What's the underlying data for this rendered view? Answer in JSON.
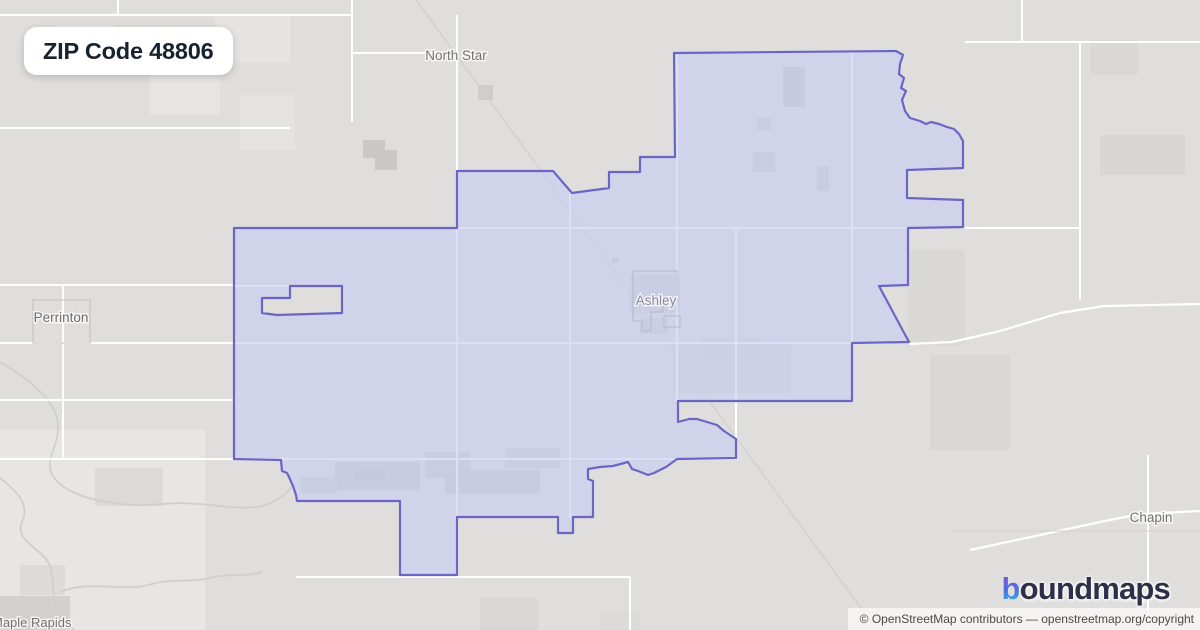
{
  "title_badge": {
    "text": "ZIP Code 48806"
  },
  "logo": {
    "first_letter": "b",
    "rest": "oundmaps"
  },
  "attribution": {
    "text": "© OpenStreetMap contributors — openstreetmap.org/copyright"
  },
  "map": {
    "bg": "#dfdedc",
    "road_color": "#ffffff",
    "rail_color": "#d2d1cf",
    "river_color": "#d0cfcd",
    "gray_line_color": "#d4d3d1",
    "boundary": {
      "stroke": "#6b66c5",
      "fill": "rgba(199,205,241,0.62)",
      "outer": [
        [
          674,
          53
        ],
        [
          896,
          51
        ],
        [
          903,
          55
        ],
        [
          900,
          64
        ],
        [
          899,
          74
        ],
        [
          904,
          78
        ],
        [
          901,
          88
        ],
        [
          906,
          91
        ],
        [
          902,
          100
        ],
        [
          905,
          111
        ],
        [
          910,
          118
        ],
        [
          920,
          121
        ],
        [
          926,
          124
        ],
        [
          931,
          122
        ],
        [
          939,
          124
        ],
        [
          947,
          127
        ],
        [
          954,
          129
        ],
        [
          959,
          134
        ],
        [
          963,
          141
        ],
        [
          963,
          168
        ],
        [
          907,
          170
        ],
        [
          907,
          198
        ],
        [
          963,
          200
        ],
        [
          963,
          227
        ],
        [
          908,
          228
        ],
        [
          908,
          285
        ],
        [
          879,
          286
        ],
        [
          909,
          342
        ],
        [
          852,
          343
        ],
        [
          852,
          401
        ],
        [
          678,
          401
        ],
        [
          678,
          422
        ],
        [
          689,
          419
        ],
        [
          697,
          419
        ],
        [
          707,
          422
        ],
        [
          717,
          425
        ],
        [
          724,
          431
        ],
        [
          730,
          435
        ],
        [
          736,
          439
        ],
        [
          736,
          458
        ],
        [
          677,
          459
        ],
        [
          666,
          467
        ],
        [
          654,
          473
        ],
        [
          648,
          475
        ],
        [
          638,
          471
        ],
        [
          632,
          469
        ],
        [
          628,
          462
        ],
        [
          613,
          466
        ],
        [
          600,
          467
        ],
        [
          588,
          469
        ],
        [
          588,
          479
        ],
        [
          593,
          481
        ],
        [
          593,
          517
        ],
        [
          573,
          517
        ],
        [
          573,
          533
        ],
        [
          558,
          533
        ],
        [
          558,
          517
        ],
        [
          457,
          517
        ],
        [
          457,
          575
        ],
        [
          400,
          575
        ],
        [
          400,
          501
        ],
        [
          297,
          501
        ],
        [
          296,
          495
        ],
        [
          293,
          486
        ],
        [
          289,
          477
        ],
        [
          287,
          473
        ],
        [
          282,
          471
        ],
        [
          281,
          460
        ],
        [
          234,
          459
        ],
        [
          234,
          228
        ],
        [
          457,
          228
        ],
        [
          457,
          171
        ],
        [
          553,
          171
        ],
        [
          572,
          193
        ],
        [
          609,
          188
        ],
        [
          609,
          172
        ],
        [
          640,
          172
        ],
        [
          640,
          157
        ],
        [
          675,
          157
        ]
      ],
      "hole": [
        [
          290,
          286
        ],
        [
          342,
          286
        ],
        [
          342,
          313
        ],
        [
          277,
          315
        ],
        [
          262,
          313
        ],
        [
          262,
          298
        ],
        [
          290,
          298
        ]
      ]
    },
    "roads": [
      [
        0,
        15,
        352,
        15
      ],
      [
        118,
        0,
        118,
        15
      ],
      [
        352,
        0,
        352,
        122
      ],
      [
        0,
        128,
        290,
        128
      ],
      [
        0,
        285,
        234,
        285
      ],
      [
        234,
        286,
        342,
        286
      ],
      [
        63,
        285,
        63,
        460
      ],
      [
        0,
        343,
        852,
        343
      ],
      [
        0,
        400,
        234,
        400
      ],
      [
        0,
        459,
        736,
        459
      ],
      [
        352,
        53,
        457,
        53
      ],
      [
        457,
        15,
        457,
        517
      ],
      [
        570,
        190,
        570,
        517
      ],
      [
        677,
        53,
        677,
        401
      ],
      [
        736,
        228,
        736,
        459
      ],
      [
        852,
        52,
        852,
        343
      ],
      [
        234,
        228,
        908,
        228
      ],
      [
        965,
        42,
        1200,
        42
      ],
      [
        1022,
        0,
        1022,
        42
      ],
      [
        1080,
        42,
        1080,
        300
      ],
      [
        965,
        228,
        1080,
        228
      ],
      [
        296,
        577,
        630,
        577
      ],
      [
        630,
        577,
        630,
        630
      ],
      [
        1148,
        455,
        1148,
        630
      ]
    ],
    "road_paths": [
      [
        [
          909,
          344
        ],
        [
          952,
          342
        ],
        [
          1000,
          331
        ],
        [
          1060,
          313
        ],
        [
          1104,
          306
        ],
        [
          1200,
          304
        ]
      ],
      [
        [
          970,
          550
        ],
        [
          1040,
          535
        ],
        [
          1100,
          522
        ],
        [
          1140,
          514
        ],
        [
          1200,
          511
        ]
      ]
    ],
    "gray_lines": [
      [
        950,
        531,
        1200,
        531
      ]
    ],
    "railroads": [
      [
        [
          416,
          0
        ],
        [
          877,
          630
        ]
      ]
    ],
    "rivers": [
      "M0,362 C30,380 56,400 58,424 C60,448 40,462 56,480 C74,500 122,508 162,504 C202,500 236,512 262,506 C278,502 289,492 293,484",
      "M0,478 C18,492 30,505 22,522 C14,540 40,548 48,562 C56,576 50,596 58,612 C62,622 70,626 74,630",
      "M60,592 C92,579 122,593 152,584 C172,578 190,583 210,578 C230,573 248,577 262,572"
    ],
    "patches": [
      {
        "x": 55,
        "y": 25,
        "w": 60,
        "h": 45,
        "c": "#e6e5e3"
      },
      {
        "x": 150,
        "y": 60,
        "w": 70,
        "h": 55,
        "c": "#e6e5e3"
      },
      {
        "x": 215,
        "y": 15,
        "w": 75,
        "h": 48,
        "c": "#e5e4e2"
      },
      {
        "x": 240,
        "y": 95,
        "w": 55,
        "h": 55,
        "c": "#e4e3e1"
      },
      {
        "x": 363,
        "y": 140,
        "w": 22,
        "h": 18,
        "c": "#c9c8c6"
      },
      {
        "x": 375,
        "y": 150,
        "w": 22,
        "h": 20,
        "c": "#c9c8c6"
      },
      {
        "x": 478,
        "y": 85,
        "w": 15,
        "h": 15,
        "c": "#cecdcb"
      },
      {
        "x": 0,
        "y": 430,
        "w": 205,
        "h": 200,
        "c": "#e7e6e4"
      },
      {
        "x": 95,
        "y": 468,
        "w": 68,
        "h": 38,
        "c": "#dbdad8"
      },
      {
        "x": 0,
        "y": 596,
        "w": 70,
        "h": 34,
        "c": "#d2d1cf"
      },
      {
        "x": 20,
        "y": 565,
        "w": 45,
        "h": 30,
        "c": "#dcdbd9"
      },
      {
        "x": 783,
        "y": 67,
        "w": 22,
        "h": 40,
        "c": "#c9c8c6"
      },
      {
        "x": 757,
        "y": 118,
        "w": 14,
        "h": 12,
        "c": "#cecdcb"
      },
      {
        "x": 753,
        "y": 152,
        "w": 22,
        "h": 20,
        "c": "#cecdcb"
      },
      {
        "x": 817,
        "y": 166,
        "w": 12,
        "h": 25,
        "c": "#cecdcb"
      },
      {
        "x": 630,
        "y": 275,
        "w": 50,
        "h": 38,
        "c": "#d0cfcd"
      },
      {
        "x": 640,
        "y": 318,
        "w": 28,
        "h": 16,
        "c": "#d0cfcd"
      },
      {
        "x": 673,
        "y": 345,
        "w": 118,
        "h": 48,
        "c": "#d8d7d5"
      },
      {
        "x": 700,
        "y": 338,
        "w": 60,
        "h": 20,
        "c": "#d6d5d3"
      },
      {
        "x": 335,
        "y": 462,
        "w": 85,
        "h": 28,
        "c": "#cbcac8"
      },
      {
        "x": 425,
        "y": 452,
        "w": 45,
        "h": 26,
        "c": "#cdccca"
      },
      {
        "x": 445,
        "y": 470,
        "w": 95,
        "h": 24,
        "c": "#cbcac8"
      },
      {
        "x": 505,
        "y": 448,
        "w": 55,
        "h": 20,
        "c": "#cfcecc"
      },
      {
        "x": 300,
        "y": 477,
        "w": 38,
        "h": 16,
        "c": "#d0cfcd"
      },
      {
        "x": 355,
        "y": 470,
        "w": 30,
        "h": 10,
        "c": "#c4c3c1"
      },
      {
        "x": 908,
        "y": 250,
        "w": 57,
        "h": 95,
        "c": "#d9d8d6"
      },
      {
        "x": 930,
        "y": 355,
        "w": 80,
        "h": 95,
        "c": "#d9d8d6"
      },
      {
        "x": 1090,
        "y": 40,
        "w": 48,
        "h": 35,
        "c": "#d9d8d6"
      },
      {
        "x": 1100,
        "y": 135,
        "w": 85,
        "h": 40,
        "c": "#d7d6d4"
      },
      {
        "x": 480,
        "y": 598,
        "w": 58,
        "h": 32,
        "c": "#d8d7d5"
      },
      {
        "x": 600,
        "y": 612,
        "w": 40,
        "h": 18,
        "c": "#dbdad8"
      },
      {
        "x": 612,
        "y": 258,
        "w": 6,
        "h": 5,
        "c": "#c6c6c4"
      }
    ],
    "perrinton_box": {
      "x": 33,
      "y": 300,
      "w": 57,
      "h": 43,
      "stroke": "#c6c5c3"
    },
    "ashley_outline": "M633,271 L677,271 L677,301 L663,301 L663,312 L651,312 L651,331 L642,331 L642,321 L633,321 Z M664,316 L680,316 L680,327 L664,327 Z",
    "labels": [
      {
        "id": "north-star",
        "text": "North Star",
        "x": 456,
        "y": 60,
        "size": 13.5,
        "color": "#757372"
      },
      {
        "id": "perrinton",
        "text": "Perrinton",
        "x": 61,
        "y": 322,
        "size": 13.5,
        "color": "#6e6e6e"
      },
      {
        "id": "ashley",
        "text": "Ashley",
        "x": 656,
        "y": 305,
        "size": 13.5,
        "color": "#8c8c9a"
      },
      {
        "id": "chapin",
        "text": "Chapin",
        "x": 1151,
        "y": 522,
        "size": 13.5,
        "color": "#757372"
      },
      {
        "id": "maple-rapids",
        "text": "Maple Rapids",
        "x": -8,
        "y": 627,
        "size": 13,
        "color": "#757372",
        "anchor": "start"
      }
    ]
  }
}
